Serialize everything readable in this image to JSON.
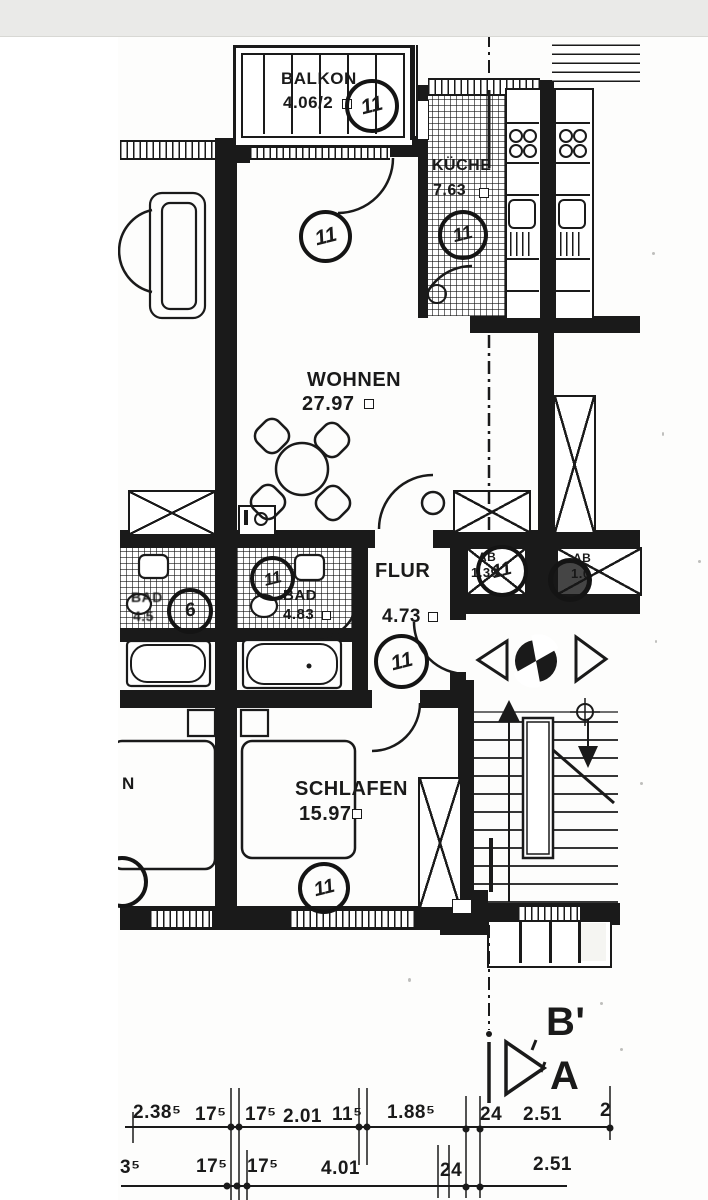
{
  "meta": {
    "document_type": "scanned apartment floor plan",
    "language": "de"
  },
  "palette": {
    "ink": "#1a1a1a",
    "paper": "#fdfdfc",
    "scan_gray": "#eaeae8"
  },
  "rooms": {
    "balkon": {
      "name": "BALKON",
      "area": "4.06/2",
      "unit": "11"
    },
    "kueche": {
      "name": "KÜCHE",
      "area": "7.63",
      "unit": "11"
    },
    "wohnen": {
      "name": "WOHNEN",
      "area": "27.97",
      "unit": "11"
    },
    "flur": {
      "name": "FLUR",
      "area": "4.73",
      "unit": "11"
    },
    "bad": {
      "name": "BAD",
      "area": "4.83",
      "unit": "11"
    },
    "bad_neighbor": {
      "name": "BAD",
      "area": "4.5",
      "unit": "6"
    },
    "schlafen": {
      "name": "SCHLAFEN",
      "area": "15.97",
      "unit": "11"
    },
    "schlafen_neighbor_partial": {
      "name": "N"
    },
    "abstell_1": {
      "name": "AB",
      "area": "1.39",
      "unit": "11"
    },
    "abstell_2": {
      "name": "AB",
      "area": "1.0"
    }
  },
  "section_marker": {
    "top": "B'",
    "bottom": "A"
  },
  "dimensions": {
    "row1": [
      "2.38⁵",
      "17⁵",
      "17⁵",
      "2.01",
      "11⁵",
      "1.88⁵",
      "24",
      "2.51",
      "2"
    ],
    "row2": [
      "3⁵",
      "17⁵",
      "17⁵",
      "4.01",
      "24",
      "2.51"
    ]
  }
}
